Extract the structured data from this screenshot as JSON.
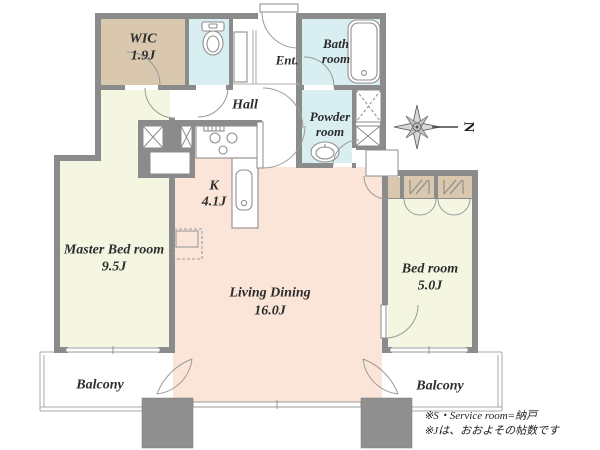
{
  "rooms": {
    "wic": {
      "name": "WIC",
      "area": "1.9J"
    },
    "entrance": {
      "name": "Ent."
    },
    "hall": {
      "name": "Hall"
    },
    "bathroom": {
      "name": "Bath room"
    },
    "powder_room": {
      "name": "Powder room"
    },
    "kitchen": {
      "name": "K",
      "area": "4.1J"
    },
    "master_bedroom": {
      "name": "Master Bed room",
      "area": "9.5J"
    },
    "living_dining": {
      "name": "Living Dining",
      "area": "16.0J"
    },
    "bedroom": {
      "name": "Bed room",
      "area": "5.0J"
    },
    "balcony_left": {
      "name": "Balcony"
    },
    "balcony_right": {
      "name": "Balcony"
    }
  },
  "compass": {
    "label": "N"
  },
  "notes": {
    "line1": "※S・Service room=納戸",
    "line2": "※Jは、おおよその帖数です"
  },
  "colors": {
    "wall": "#8b8b8b",
    "pillar": "#8f8f8f",
    "room_ldk": "#fae5d8",
    "room_bedroom": "#f5f6e2",
    "room_wet": "#d9eef1",
    "closet": "#d9c7ae",
    "fixture_line": "#8f8f8f",
    "balcony_line": "#a8a8a8"
  }
}
